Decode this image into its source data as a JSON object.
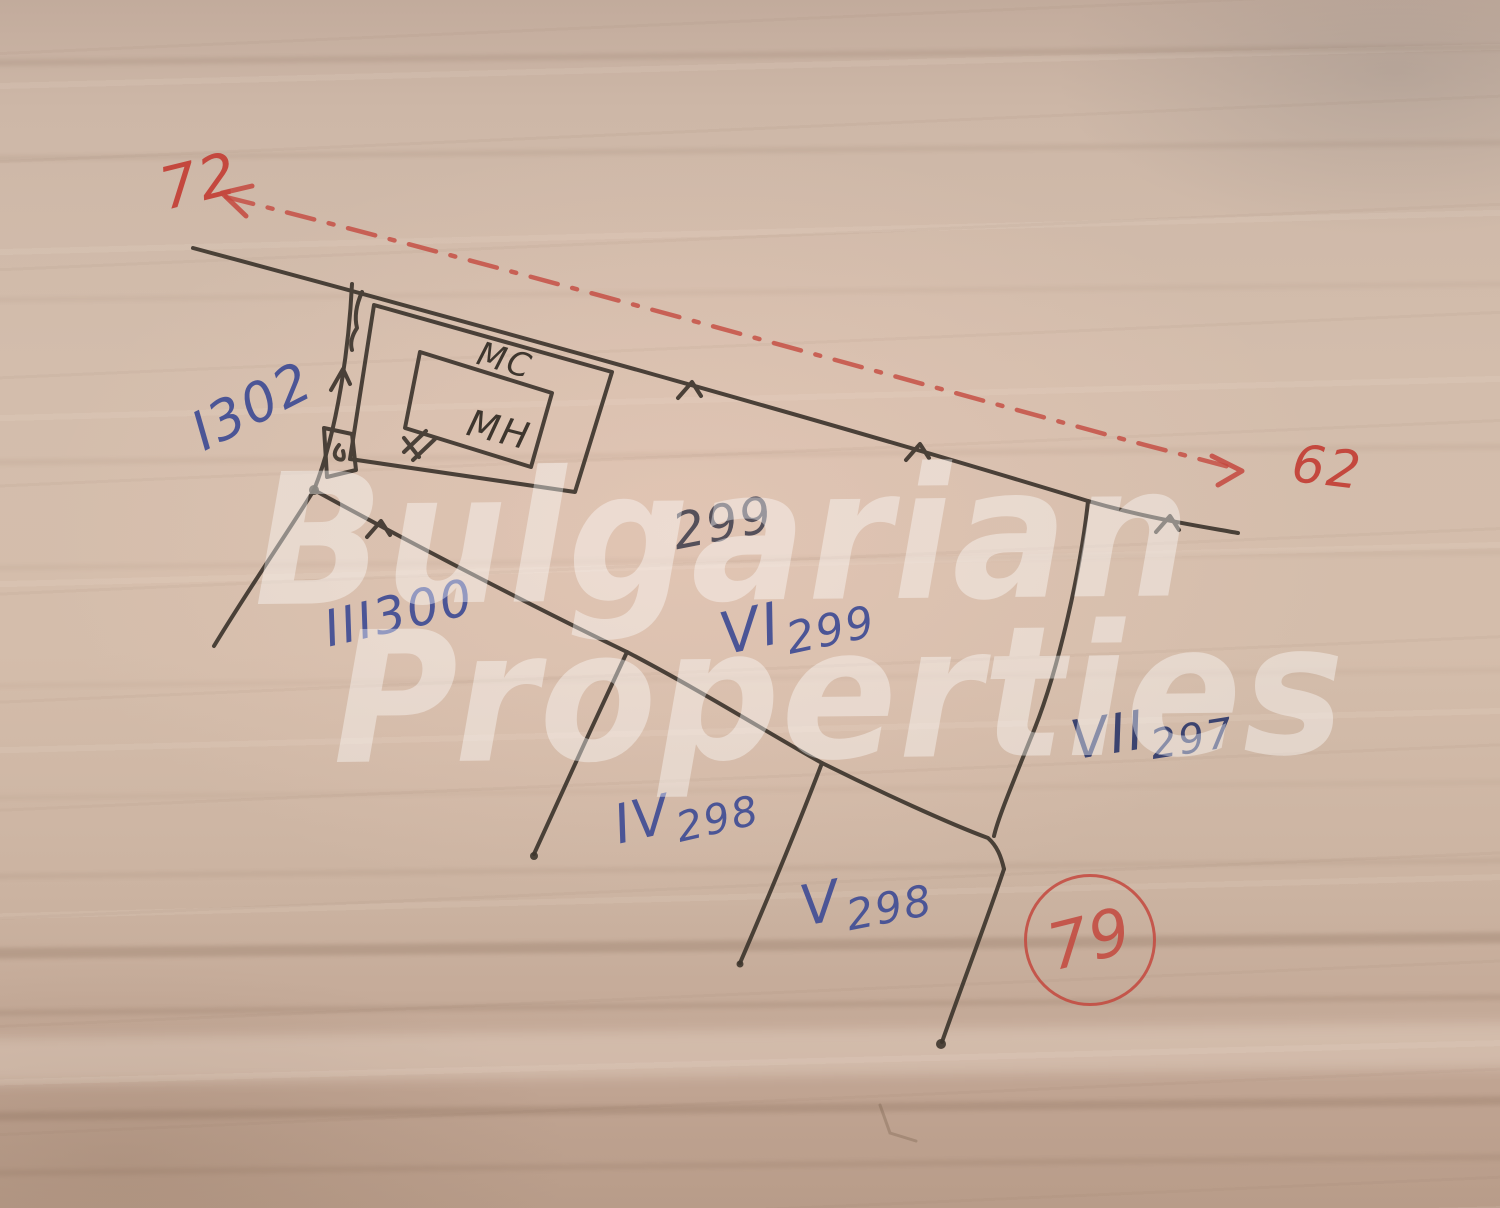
{
  "watermark": {
    "line1": "Bulgarian",
    "line2": "Properties"
  },
  "red_annotations": {
    "left_parcel": "72",
    "right_parcel": "62",
    "sheet_circle": "79"
  },
  "parcels": {
    "p302": {
      "roman": "I",
      "number": "302"
    },
    "p300": {
      "roman": "III",
      "number": "300"
    },
    "p299": {
      "roman": "VI",
      "number": "299"
    },
    "p299_note": "299",
    "p297": {
      "roman": "VII",
      "number": "297"
    },
    "p298_iv": {
      "roman": "IV",
      "number": "298"
    },
    "p298_v": {
      "roman": "V",
      "number": "298"
    }
  },
  "building_labels": {
    "top": "МС",
    "inner": "МН"
  },
  "colors": {
    "ink": "#3e362e",
    "blue": "#4b5596",
    "blue_dark": "#3b436f",
    "pencil": "#55505a",
    "red": "#c4483e"
  }
}
